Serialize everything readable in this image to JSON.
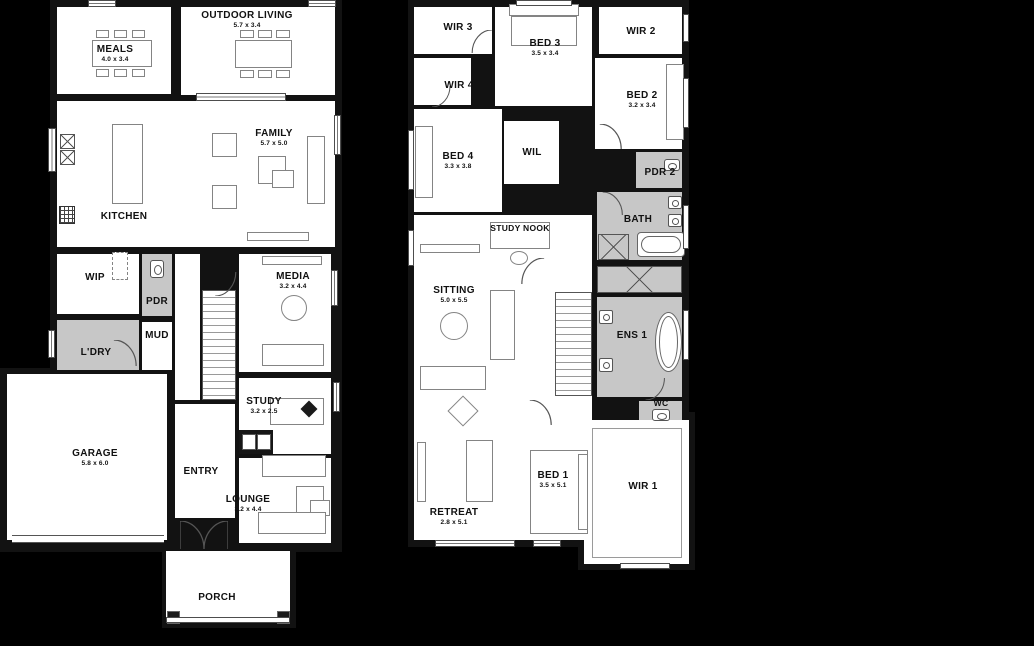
{
  "colors": {
    "background": "#000000",
    "wall": "#121212",
    "room_fill": "#ffffff",
    "wet_area_fill": "#c7c7c7",
    "furniture_stroke": "#848484",
    "label_color": "#111111"
  },
  "plans": {
    "ground": {
      "rooms": {
        "meals": {
          "label": "MEALS",
          "dims": "4.0 x 3.4"
        },
        "outdoor_living": {
          "label": "OUTDOOR LIVING",
          "dims": "5.7 x 3.4"
        },
        "kitchen": {
          "label": "KITCHEN",
          "dims": ""
        },
        "family": {
          "label": "FAMILY",
          "dims": "5.7 x 5.0"
        },
        "wip": {
          "label": "WIP",
          "dims": ""
        },
        "pdr": {
          "label": "PDR",
          "dims": ""
        },
        "mud": {
          "label": "MUD",
          "dims": ""
        },
        "ldry": {
          "label": "L'DRY",
          "dims": ""
        },
        "media": {
          "label": "MEDIA",
          "dims": "3.2 x 4.4"
        },
        "study": {
          "label": "STUDY",
          "dims": "3.2 x 2.5"
        },
        "entry": {
          "label": "ENTRY",
          "dims": ""
        },
        "garage": {
          "label": "GARAGE",
          "dims": "5.8 x 6.0"
        },
        "lounge": {
          "label": "LOUNGE",
          "dims": "3.2 x 4.4"
        },
        "porch": {
          "label": "PORCH",
          "dims": ""
        }
      }
    },
    "first": {
      "rooms": {
        "wir3": {
          "label": "WIR 3",
          "dims": ""
        },
        "bed3": {
          "label": "BED 3",
          "dims": "3.5 x 3.4"
        },
        "wir2": {
          "label": "WIR 2",
          "dims": ""
        },
        "bed2": {
          "label": "BED 2",
          "dims": "3.2 x 3.4"
        },
        "wir4": {
          "label": "WIR 4",
          "dims": ""
        },
        "bed4": {
          "label": "BED 4",
          "dims": "3.3 x 3.8"
        },
        "wil": {
          "label": "WIL",
          "dims": ""
        },
        "pdr2": {
          "label": "PDR 2",
          "dims": ""
        },
        "bath": {
          "label": "BATH",
          "dims": ""
        },
        "study_nook": {
          "label": "STUDY NOOK",
          "dims": ""
        },
        "sitting": {
          "label": "SITTING",
          "dims": "5.0 x 5.5"
        },
        "ens1": {
          "label": "ENS 1",
          "dims": ""
        },
        "wc": {
          "label": "WC",
          "dims": ""
        },
        "retreat": {
          "label": "RETREAT",
          "dims": "2.8 x 5.1"
        },
        "bed1": {
          "label": "BED 1",
          "dims": "3.5 x 5.1"
        },
        "wir1": {
          "label": "WIR 1",
          "dims": ""
        }
      }
    }
  }
}
